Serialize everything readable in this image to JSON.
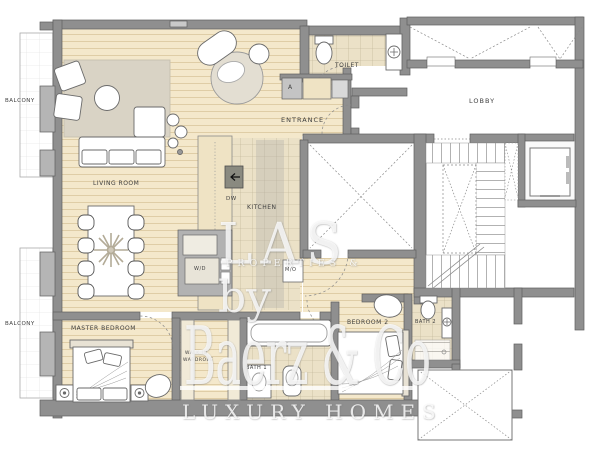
{
  "plan": {
    "rooms": {
      "balcony_top": "BALCONY",
      "balcony_bottom": "BALCONY",
      "living_room": "LIVING ROOM",
      "toilet": "TOILET",
      "entrance": "ENTRANCE",
      "lobby": "LOBBY",
      "kitchen": "KITCHEN",
      "master_bedroom": "MASTER BEDROOM",
      "walk_in_wardrobe_line1": "WALK IN",
      "walk_in_wardrobe_line2": "WARDROBE",
      "bath_1": "BATH 1",
      "bedroom_2": "BEDROOM 2",
      "bath_2": "BATH 2"
    },
    "appliances": {
      "dishwasher": "DW",
      "washer_dryer": "W/D",
      "micro_oven": "M/O",
      "closet_a": "A"
    }
  },
  "watermark": {
    "top_line": "LAS",
    "top_subline": "PROPERTIES &",
    "connector": "by",
    "brand": "Baerz & Co",
    "tagline": "LUXURY HOMES"
  },
  "colors": {
    "wall": "#8f8f8f",
    "wall_outline": "#5f5f5f",
    "wood_floor": "#f4e8cb",
    "tile_floor": "#ebe1c7",
    "rug": "#d9d3c5",
    "label_text": "#3e3e3e",
    "watermark": "#ffffff"
  }
}
